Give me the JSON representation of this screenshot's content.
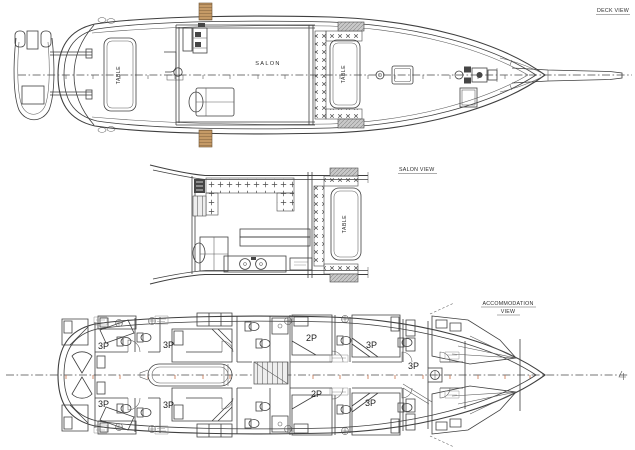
{
  "drawing": {
    "kind": "yacht-general-arrangement-plan",
    "colors": {
      "paper": "#ffffff",
      "ink": "#3f3f3f",
      "wood_step": "#c59a66",
      "station_marks": "#c9714a",
      "hatch_gray": "#c9c9c9"
    },
    "views": {
      "deck": {
        "title": "DECK VIEW",
        "salon_label": "SALON",
        "aft_table_label": "TABLE",
        "fore_table_label": "TABLE"
      },
      "salon": {
        "title": "SALON VIEW",
        "table_label": "TABLE"
      },
      "accommodation": {
        "title_line1": "ACCOMMODATION",
        "title_line2": "VIEW",
        "cabins": [
          {
            "position": "aft-starboard",
            "label": "3P"
          },
          {
            "position": "aft-port",
            "label": "3P"
          },
          {
            "position": "mid-aft-starboard",
            "label": "3P"
          },
          {
            "position": "mid-aft-port",
            "label": "3P"
          },
          {
            "position": "mid-starboard",
            "label": "2P"
          },
          {
            "position": "mid-port",
            "label": "2P"
          },
          {
            "position": "mid-fwd-starboard",
            "label": "3P"
          },
          {
            "position": "mid-fwd-port",
            "label": "3P"
          },
          {
            "position": "forward",
            "label": "3P"
          }
        ]
      }
    }
  }
}
